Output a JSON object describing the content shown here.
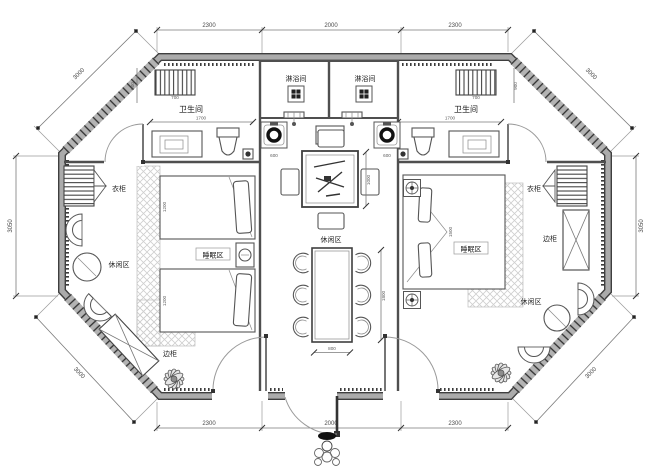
{
  "drawing": {
    "kind": "octagonal cabin floor plan, mirrored twin-suite layout with central lounge"
  },
  "rooms": {
    "shower_left": "淋浴间",
    "shower_right": "淋浴间",
    "bath_left": "卫生间",
    "bath_right": "卫生间",
    "wardrobe_left": "衣柜",
    "wardrobe_right": "衣柜",
    "side_cabinet_left": "边柜",
    "side_cabinet_right": "边柜",
    "sleep_left": "睡眠区",
    "sleep_right": "睡眠区",
    "leisure_left": "休闲区",
    "leisure_center": "休闲区",
    "leisure_right": "休闲区"
  },
  "dims": {
    "top": [
      "2300",
      "2000",
      "2300"
    ],
    "bottom": [
      "2300",
      "2000",
      "2300"
    ],
    "side_left": "3050",
    "side_right": "3050",
    "diag_tl": "3000",
    "diag_tr": "3000",
    "diag_bl": "3000",
    "diag_br": "3000",
    "small": {
      "radiator_l": "700",
      "radiator_r": "700",
      "bath_l": "1700",
      "bath_r": "1700",
      "bath_h_l": "900",
      "bath_h_r": "900",
      "basin_l": "600",
      "basin_r": "600",
      "tea_table": "1000",
      "dining_len": "1800",
      "dining_wid": "800",
      "bed1": "1200",
      "bed2": "1200",
      "bed_r": "1500"
    }
  },
  "colors": {
    "wall_edge": "#3f3f3f",
    "wall_fill": "#ababab",
    "line": "#555555",
    "hatch": "#cfcfcf",
    "dim_text": "#4a4a4a"
  }
}
